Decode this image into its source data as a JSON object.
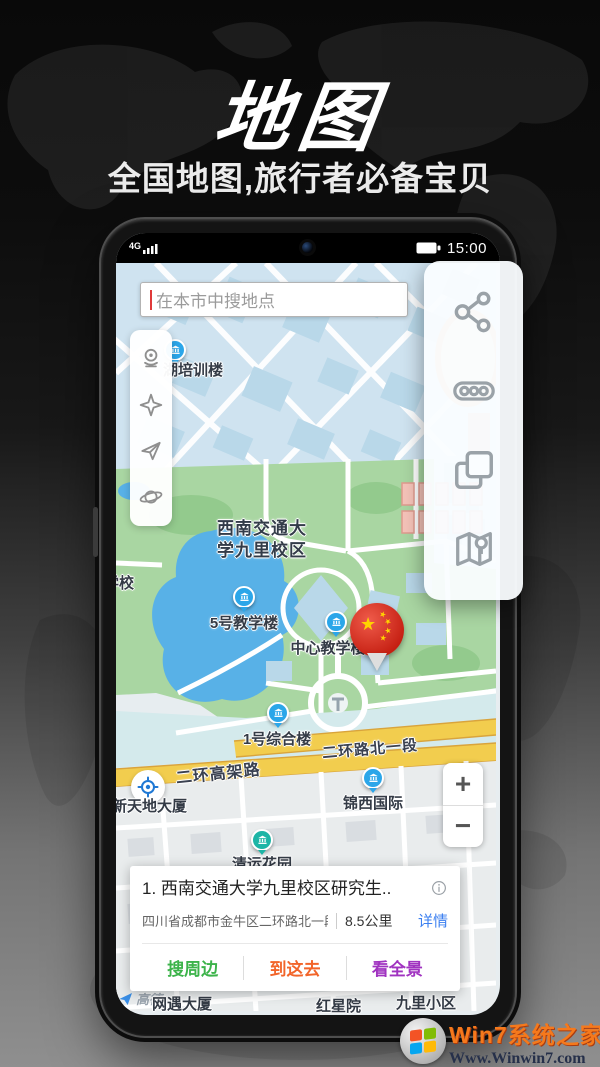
{
  "hero": {
    "title": "地图",
    "subtitle": "全国地图,旅行者必备宝贝"
  },
  "statusbar": {
    "network": "4G",
    "time": "15:00"
  },
  "search": {
    "placeholder": "在本市中搜地点"
  },
  "left_tools": {
    "icons": [
      "streetview",
      "compass",
      "send",
      "planet"
    ]
  },
  "right_panel": {
    "icons": [
      "share",
      "traffic",
      "layers",
      "map-location"
    ]
  },
  "map": {
    "labels": {
      "training_building": "湖培训楼",
      "campus_line1": "西南交通大",
      "campus_line2": "学九里校区",
      "school_partial": "学校",
      "building5": "5号教学楼",
      "central_building": "中心教学楼",
      "complex1": "1号综合楼",
      "road_north_section": "二环路北一段",
      "road_elevated": "二环高架路",
      "xintiandi": "新天地大厦",
      "jinxi": "锦西国际",
      "qingyun_garden": "清运花园",
      "yuda_building": "网遇大厦",
      "hongxing": "红星院",
      "jiuli_estate": "九里小区",
      "jiuli_road": "九里",
      "amap": "高德"
    }
  },
  "zoom_control": {
    "zoom_in": "+",
    "zoom_out": "−"
  },
  "result_card": {
    "title": "1. 西南交通大学九里校区研究生..",
    "address": "四川省成都市金牛区二环路北一段11..",
    "distance": "8.5公里",
    "details_link": "详情",
    "details_color": "#3b7ff0",
    "actions": [
      {
        "label": "搜周边",
        "color": "#3cb34a"
      },
      {
        "label": "到这去",
        "color": "#f2652a"
      },
      {
        "label": "看全景",
        "color": "#a033c0"
      }
    ]
  },
  "watermark": {
    "site_name": "Win7系统之家",
    "site_url": "Www.Winwin7.com"
  },
  "colors": {
    "marker_blue": "#2ba6e9",
    "campus_green": "#a9d6a2",
    "water_blue": "#58b1e7",
    "road_yellow": "#f2cd4e",
    "pin_red": "#c51f12"
  }
}
